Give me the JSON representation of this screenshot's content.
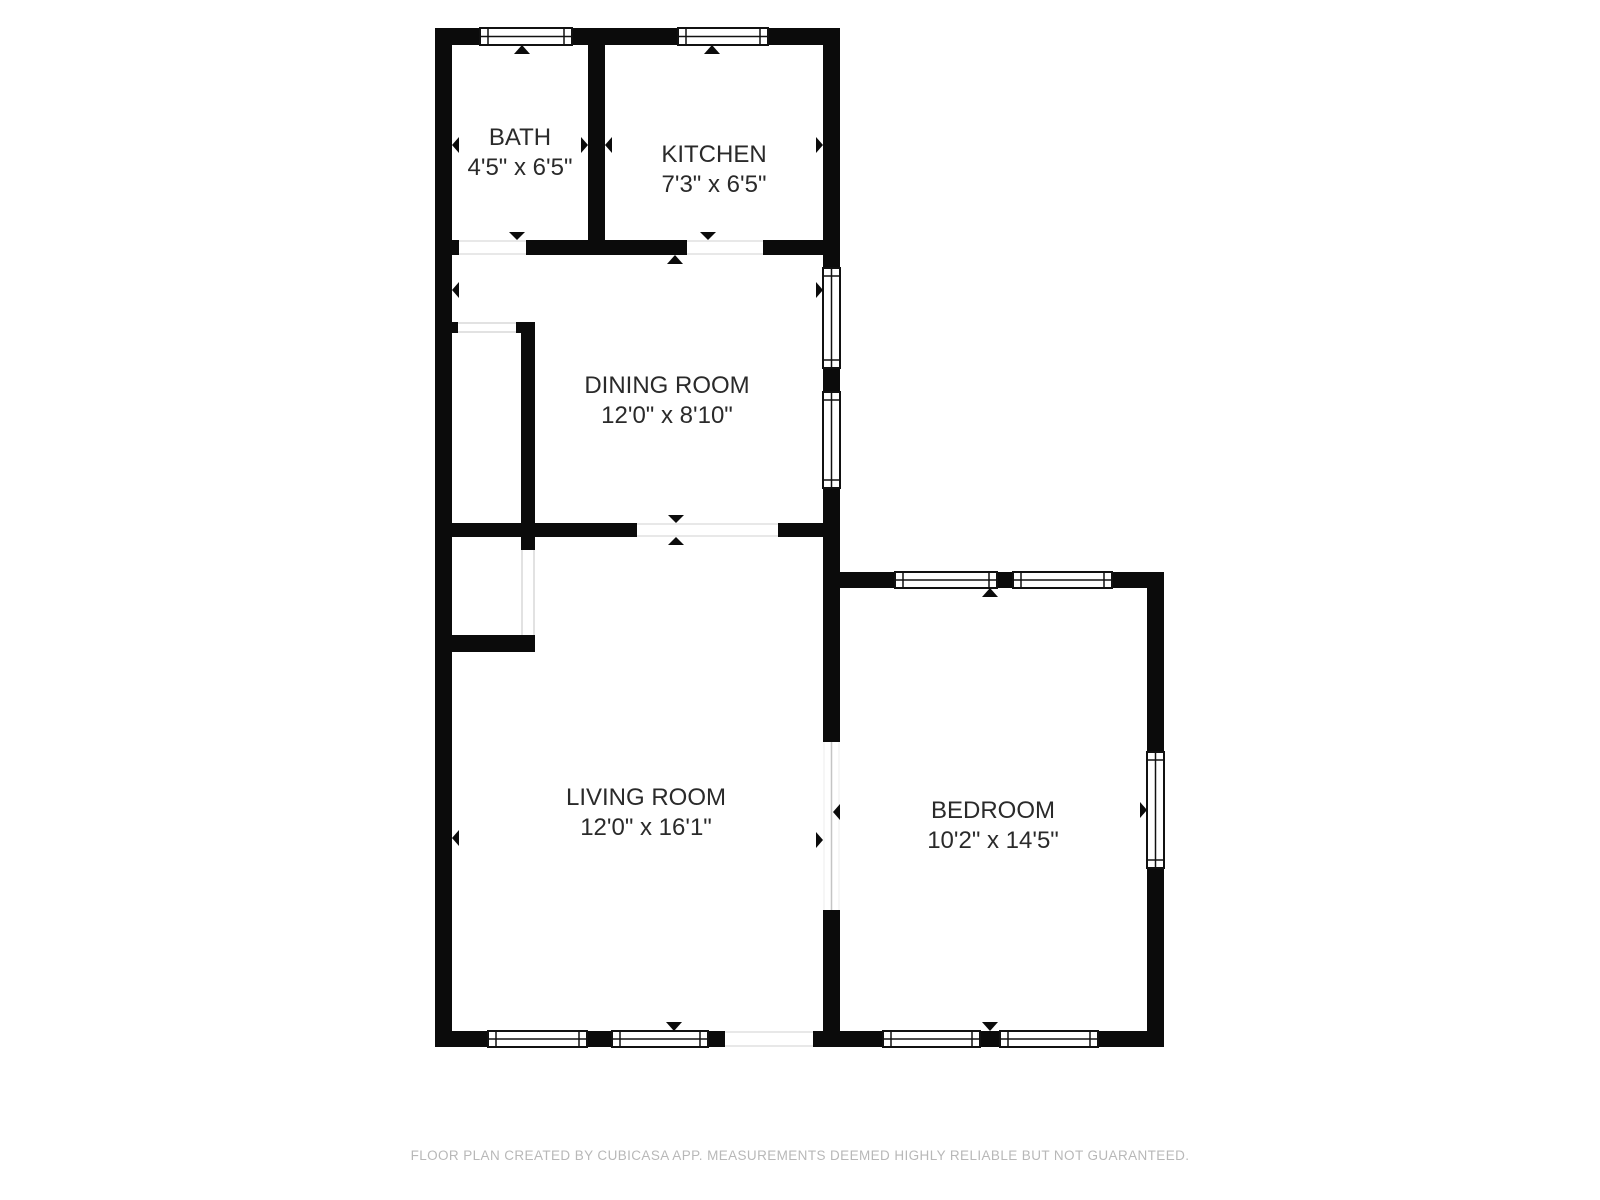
{
  "plan": {
    "rooms": [
      {
        "name": "BATH",
        "dimensions": "4'5\" x 6'5\""
      },
      {
        "name": "KITCHEN",
        "dimensions": "7'3\" x 6'5\""
      },
      {
        "name": "DINING ROOM",
        "dimensions": "12'0\" x 8'10\""
      },
      {
        "name": "LIVING ROOM",
        "dimensions": "12'0\" x 16'1\""
      },
      {
        "name": "BEDROOM",
        "dimensions": "10'2\" x 14'5\""
      }
    ],
    "footer": "FLOOR PLAN CREATED BY CUBICASA APP. MEASUREMENTS DEEMED HIGHLY RELIABLE BUT NOT GUARANTEED.",
    "colors": {
      "wall": "#0b0b0b",
      "label": "#2a2a2a",
      "footer": "#b8b8b8",
      "background": "#ffffff",
      "window_stroke": "#111111",
      "opening_line": "#e0e0e0",
      "door_line": "#c4c4c4",
      "closet_line": "#d8d8d8"
    }
  }
}
